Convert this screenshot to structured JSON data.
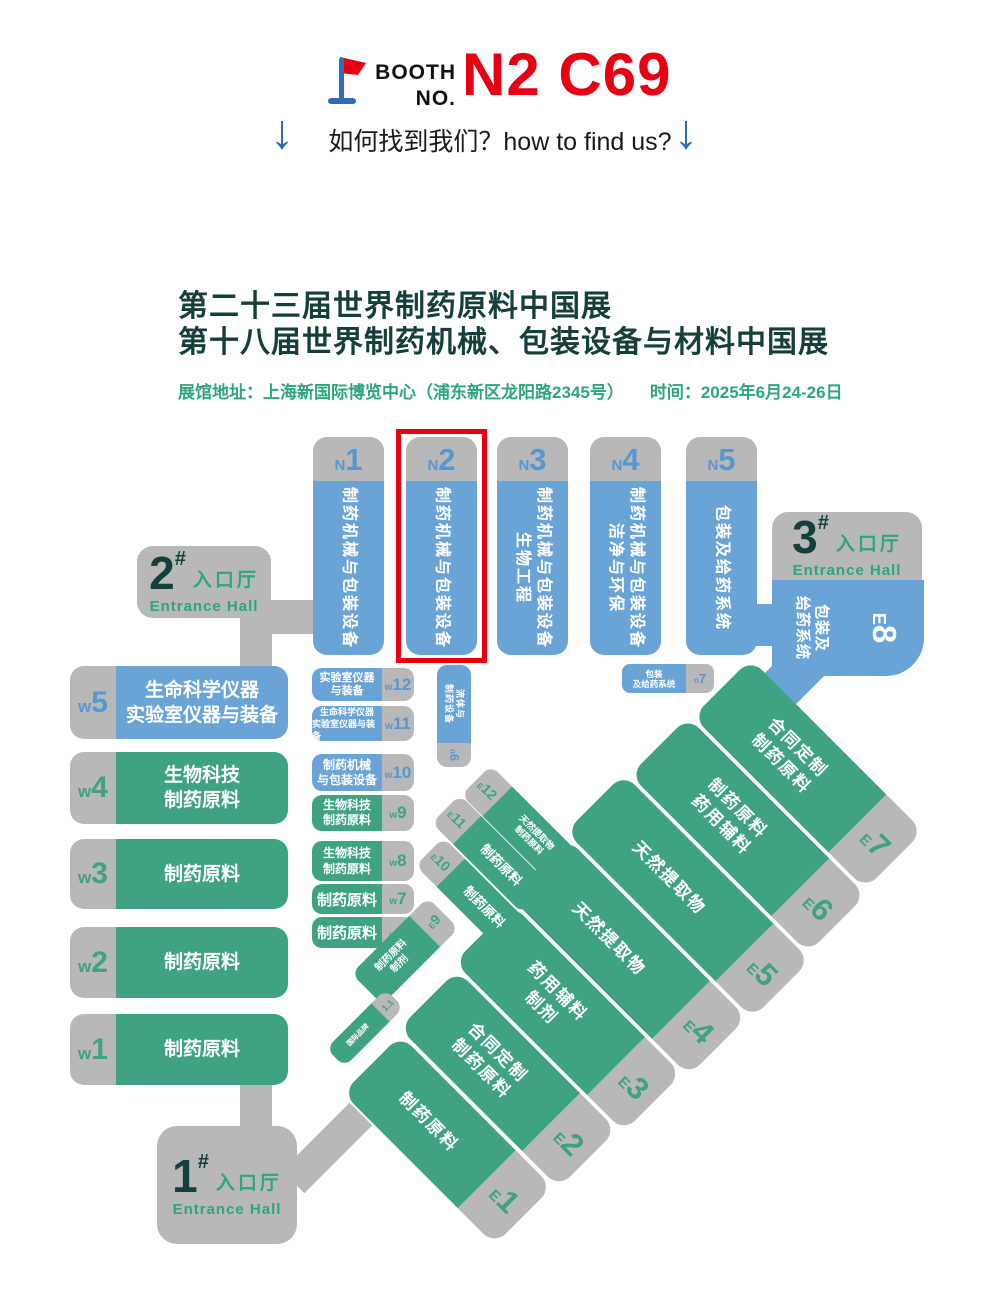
{
  "header": {
    "booth_line1": "BOOTH",
    "booth_line2": "NO.",
    "booth_number": "N2 C69",
    "find_us": "如何找到我们？how to find us?",
    "down_arrow": "↓"
  },
  "titles": {
    "line1": "第二十三届世界制药原料中国展",
    "line2": "第十八届世界制药机械、包装设备与材料中国展",
    "venue": "展馆地址：上海新国际博览中心（浦东新区龙阳路2345号）",
    "time": "时间：2025年6月24-26日"
  },
  "colors": {
    "booth_red": "#e60012",
    "hall_blue": "#6aa4d7",
    "hall_green": "#3ea283",
    "connector_gray": "#b8b8b8",
    "title_dark_teal": "#153f3a",
    "accent_green": "#2da57d",
    "label_blue": "#5797d1",
    "arrow_blue": "#2e6db4"
  },
  "map": {
    "n_halls": [
      {
        "p": "N",
        "n": "1",
        "l1": "制药机械与包装设备",
        "l2": ""
      },
      {
        "p": "N",
        "n": "2",
        "l1": "制药机械与包装设备",
        "l2": ""
      },
      {
        "p": "N",
        "n": "3",
        "l1": "制药机械与包装设备",
        "l2": "生物工程"
      },
      {
        "p": "N",
        "n": "4",
        "l1": "制药机械与包装设备",
        "l2": "洁净与环保"
      },
      {
        "p": "N",
        "n": "5",
        "l1": "包装及给药系统",
        "l2": ""
      }
    ],
    "entrances": [
      {
        "n": "2",
        "hash": "#",
        "cn": "入口厅",
        "en": "Entrance Hall"
      },
      {
        "n": "3",
        "hash": "#",
        "cn": "入口厅",
        "en": "Entrance Hall"
      },
      {
        "n": "1",
        "hash": "#",
        "cn": "入口厅",
        "en": "Entrance Hall"
      }
    ],
    "w_large": [
      {
        "p": "w",
        "n": "5",
        "l1": "生命科学仪器",
        "l2": "实验室仪器与装备"
      },
      {
        "p": "w",
        "n": "4",
        "l1": "生物科技",
        "l2": "制药原料"
      },
      {
        "p": "w",
        "n": "3",
        "l1": "制药原料",
        "l2": ""
      },
      {
        "p": "w",
        "n": "2",
        "l1": "制药原料",
        "l2": ""
      },
      {
        "p": "w",
        "n": "1",
        "l1": "制药原料",
        "l2": ""
      }
    ],
    "w_small": [
      {
        "p": "w",
        "n": "12",
        "l1": "实验室仪器",
        "l2": "与装备"
      },
      {
        "p": "w",
        "n": "11",
        "l1": "生命科学仪器",
        "l2": "实验室仪器与装备"
      },
      {
        "p": "w",
        "n": "10",
        "l1": "制药机械",
        "l2": "与包装设备"
      },
      {
        "p": "w",
        "n": "9",
        "l1": "生物科技",
        "l2": "制药原料"
      },
      {
        "p": "w",
        "n": "8",
        "l1": "生物科技",
        "l2": "制药原料"
      },
      {
        "p": "w",
        "n": "7",
        "l1": "制药原料",
        "l2": ""
      },
      {
        "p": "w",
        "n": "6",
        "l1": "制药原料",
        "l2": ""
      }
    ],
    "n_small": [
      {
        "p": "n",
        "n": "6",
        "l1": "流体与",
        "l2": "制药设备"
      },
      {
        "p": "n",
        "n": "7",
        "l1": "包装",
        "l2": "及给药系统"
      }
    ],
    "e8": {
      "p": "E",
      "n": "8",
      "l1": "包装及",
      "l2": "给药系统"
    },
    "e_large": [
      {
        "p": "E",
        "n": "1",
        "l1": "制药原料",
        "l2": ""
      },
      {
        "p": "E",
        "n": "2",
        "l1": "合同定制",
        "l2": "制药原料"
      },
      {
        "p": "E",
        "n": "3",
        "l1": "药用辅料",
        "l2": "制剂"
      },
      {
        "p": "E",
        "n": "4",
        "l1": "天然提取物",
        "l2": ""
      },
      {
        "p": "E",
        "n": "5",
        "l1": "天然提取物",
        "l2": ""
      },
      {
        "p": "E",
        "n": "6",
        "l1": "制药原料",
        "l2": "药用辅料"
      },
      {
        "p": "E",
        "n": "7",
        "l1": "合同定制",
        "l2": "制药原料"
      }
    ],
    "e_small": [
      {
        "p": "E",
        "n": "12",
        "l1": "天然提取物",
        "l2": "制药原料"
      },
      {
        "p": "E",
        "n": "11",
        "l1": "制药原料",
        "l2": ""
      },
      {
        "p": "E",
        "n": "10",
        "l1": "制药原料",
        "l2": ""
      },
      {
        "p": "E",
        "n": "9",
        "l1": "制药原料",
        "l2": "制剂"
      },
      {
        "p": "",
        "n": "1.1",
        "l1": "国际品牌",
        "l2": ""
      }
    ]
  }
}
